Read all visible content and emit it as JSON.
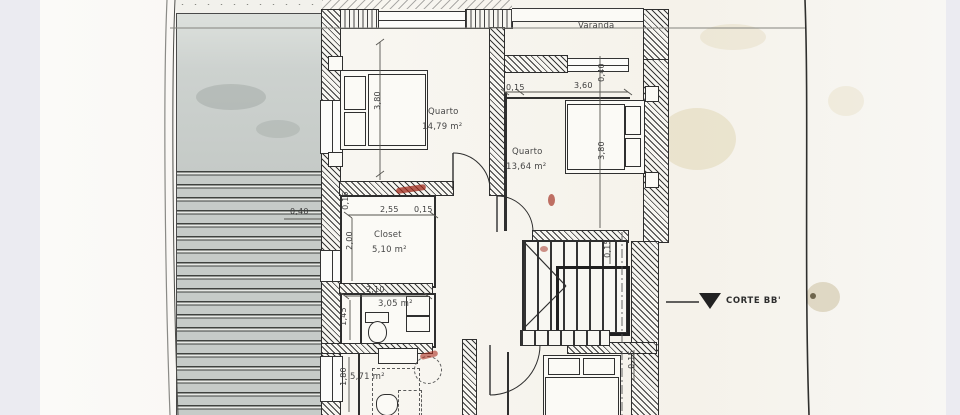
{
  "colors": {
    "backdrop": "#ebebf1",
    "paper": "#f9f8f4",
    "ink": "#2e2e2e",
    "slab_gray": "#c9cfcc",
    "stain_yellow": "#cdbb8a",
    "stain_red": "#a03226"
  },
  "rooms": {
    "varanda": {
      "label": "Varanda"
    },
    "quarto1": {
      "label": "Quarto",
      "area": "14,79 m²"
    },
    "quarto2": {
      "label": "Quarto",
      "area": "13,64 m²"
    },
    "closet": {
      "label": "Closet",
      "area": "5,10 m²"
    },
    "bathroom": {
      "area": "3,05 m²"
    },
    "room_bottom": {
      "area": "5,71 m²"
    }
  },
  "dimensions": {
    "q1_depth": "3,80",
    "q2_wall_top": "0,15",
    "q2_width": "3,60",
    "q2_offset": "0,40",
    "q2_depth": "3,80",
    "roof_offset": "0,40",
    "closet_wall_v": "0,15",
    "closet_width": "2,55",
    "closet_wall_h": "0,15",
    "closet_depth": "2,00",
    "bath_width": "2,10",
    "bath_depth": "1,45",
    "room_bottom_depth": "1,80",
    "stair_wall": "0,15",
    "bedroom3_wall": "0,15"
  },
  "annotations": {
    "section_marker": "CORTE BB'"
  }
}
